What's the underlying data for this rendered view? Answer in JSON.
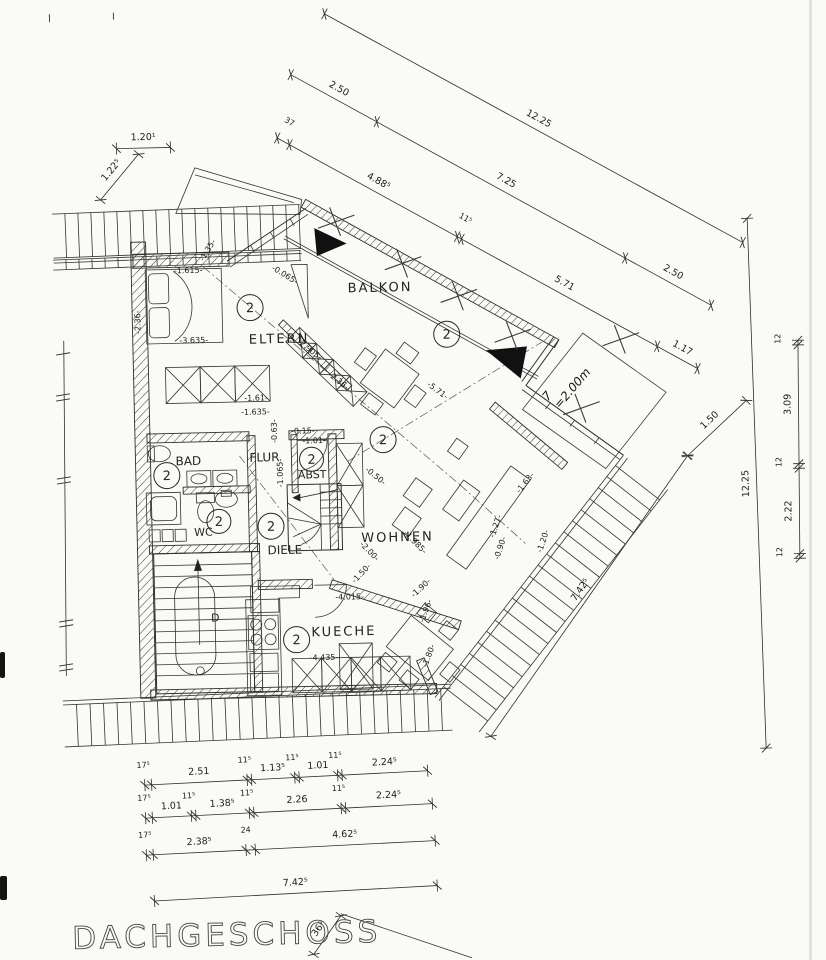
{
  "title": "DACHGESCHOSS",
  "unit_label": "2",
  "stair_label": "D",
  "handwritten_note": {
    "line1": "7",
    "line2": "=2.00m"
  },
  "rooms": {
    "eltern": "ELTERN",
    "balkon": "BALKON",
    "bad": "BAD",
    "flur": "FLUR",
    "abst": "ABST",
    "wc": "WC",
    "diele": "DIELE",
    "wohnen": "WOHNEN",
    "kueche": "KUECHE"
  },
  "dim_chains": {
    "top_outer": [
      "12.25"
    ],
    "top_mid": [
      "2.50",
      "7.25",
      "2.50"
    ],
    "top_inner": [
      "37",
      "4.88⁵",
      "11⁵",
      "5.71",
      "1.17"
    ],
    "right_outer": [
      "12.25"
    ],
    "right_inner": [
      "12",
      "3.09",
      "12",
      "2.22",
      "12"
    ],
    "bottom_row1": [
      "17⁵",
      "2.51",
      "11⁵",
      "1.13⁵",
      "11⁵",
      "1.01",
      "11⁵",
      "2.24⁵"
    ],
    "bottom_row2": [
      "17⁵",
      "1.01",
      "11⁵",
      "1.38⁵",
      "11⁵",
      "2.26",
      "11⁵",
      "2.24⁵"
    ],
    "bottom_row3": [
      "17⁵",
      "2.38⁵",
      "24",
      "4.62⁵"
    ],
    "bottom_total": [
      "7.42⁵"
    ],
    "roof_edge": [
      "7.42⁵"
    ],
    "roof_edge_ext": [
      "1.50"
    ],
    "top_left_width": [
      "1.20¹"
    ],
    "top_left_diag": [
      "1.22⁵"
    ],
    "bottom_small": [
      "36⁵"
    ]
  },
  "interior_dims": [
    "-1.615-",
    "-0.065-",
    "-1.35-",
    "-3.635-",
    "-2.905-",
    "-2.36-",
    "-2.36-",
    "-1.61-",
    "-1.635-",
    "-0.63-",
    "-0.15-",
    "-1.01-",
    "-1.065-",
    "-5.71-",
    "-0.50-",
    "-2.00-",
    "-1.985-",
    "-1.27-",
    "-0.90-",
    "-1.63-",
    "-1.20-",
    "-1.50-",
    "-1.90-",
    "-1.96-",
    "-1.80-",
    "-4.015-",
    "-4.435-"
  ]
}
